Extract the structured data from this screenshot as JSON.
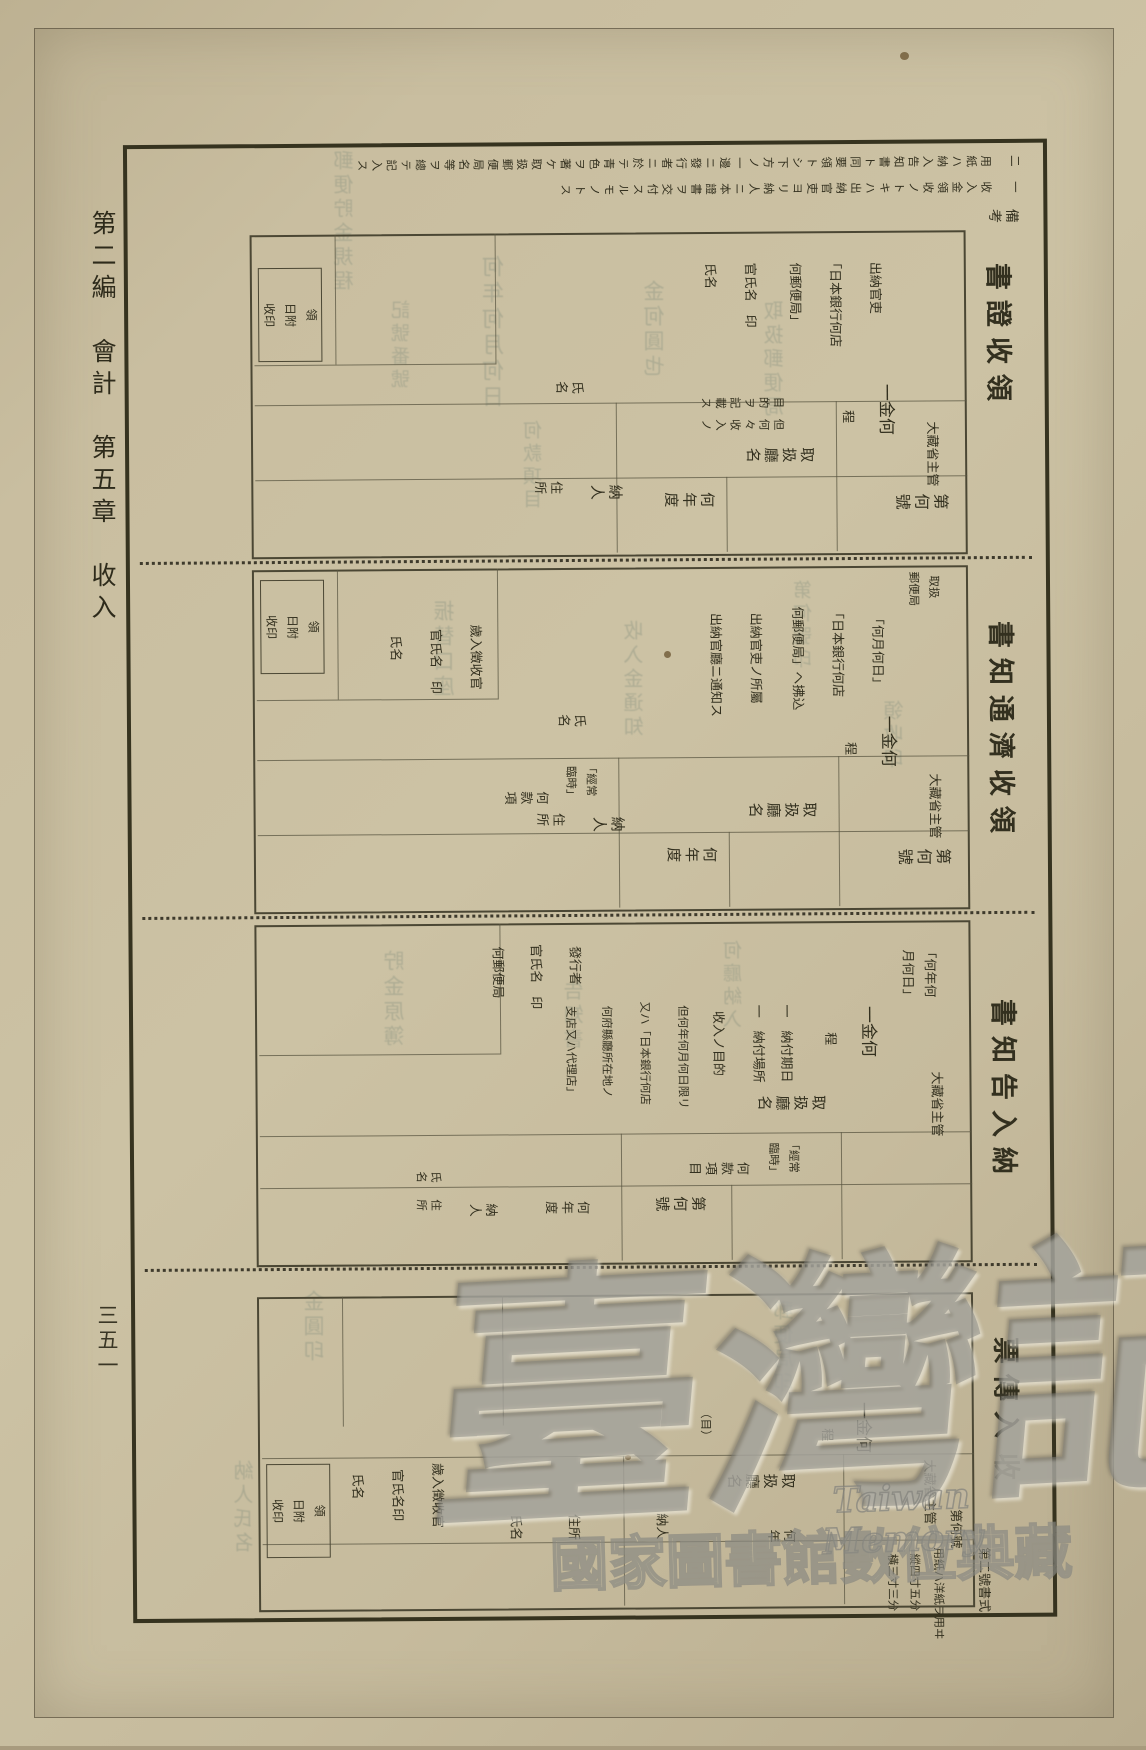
{
  "margin": {
    "chapter_header": "第二編　會計　第五章　收入",
    "page_number": "三五一"
  },
  "remarks_header": "備考",
  "sections": [
    {
      "title": "領收證書",
      "fields": {
        "serial": "第何號",
        "year": "何年度",
        "ministry": "大藏省主管",
        "office": "取扱廳名",
        "amount": "一金何",
        "amount_unit": "程",
        "purpose_1": "但何々收入ノ",
        "purpose_2": "目的ヲ記載ス",
        "payer": "納人",
        "address": "住所",
        "name": "氏名"
      },
      "instructions": [
        "出納官吏",
        "「日本銀行何店",
        "何郵便局」",
        "官氏名　印",
        "氏名"
      ],
      "stamp_box": [
        "領",
        "日附",
        "收印"
      ],
      "notes": [
        "一　收入金領收ノトキハ出納官吏ヨリ納人ニ本證書ヲ交付スルモノトス",
        "二　用紙ハ納入告知書ト同要領トシ下方ノ一邊ニ發行者ニ於テ青色ヲ著ケ取扱郵便局名等ヲ總テ記入ス"
      ]
    },
    {
      "title": "領收濟通知書",
      "fields": {
        "serial": "第何號",
        "year": "何年度",
        "budget_bracket_1": "「經常",
        "budget_bracket_2": "臨時」",
        "budget": "何款項",
        "ministry": "大藏省主管",
        "office": "取扱廳名",
        "amount": "一金何",
        "amount_unit": "程",
        "payer": "納人",
        "address": "住所",
        "name": "氏名",
        "post_office_1": "取扱",
        "post_office_2": "郵便局"
      },
      "instructions": [
        "「何月何日」",
        "「日本銀行何店",
        "何郵便局」ヘ拂込",
        "出納官吏ノ所屬",
        "出納官廳ニ通知ス"
      ],
      "collector": [
        "歲入徵收官",
        "官氏名　印",
        "氏名"
      ],
      "stamp_box": [
        "領",
        "日附",
        "收印"
      ]
    },
    {
      "title": "納入告知書",
      "fields": {
        "serial": "第何號",
        "year": "何年度",
        "budget_bracket_1": "「經常",
        "budget_bracket_2": "臨時」",
        "budget": "何款項目",
        "ministry": "大藏省主管",
        "office": "取扱廳名",
        "amount": "一金何",
        "amount_unit": "程",
        "date_1": "「何年何",
        "date_2": "月何日」",
        "due": "一　納付期日",
        "place": "一　納付場所",
        "payer": "納人",
        "address": "住所",
        "name": "氏名"
      },
      "instructions": [
        "收入ノ目的",
        "但何年何月何日限リ",
        "又ハ「日本銀行何店",
        "何府縣廳所在地ノ",
        "支店又ハ代理店」"
      ],
      "issuer": [
        "發行者",
        "官氏名　印",
        "何郵便局"
      ],
      "stamp_box": []
    },
    {
      "title": "收入傳票",
      "title_parts": [
        "入傳票",
        "收"
      ],
      "form_no": "第二號書式",
      "paper_note": [
        "用紙ハ洋紙ヲ用ヰ",
        "縱四寸五分",
        "橫三寸三分"
      ],
      "fields": {
        "serial": "第何號",
        "year": "何年",
        "ministry": "大藏省主管",
        "office": "取扱廳名",
        "amount": "一金何",
        "amount_unit": "程",
        "category": "（目）",
        "payer": "納人",
        "address": "住所",
        "name": "氏名"
      },
      "collector": [
        "歲入徵收官",
        "官氏名印",
        "氏名"
      ],
      "stamp_box": [
        "領",
        "日附",
        "收印"
      ]
    }
  ],
  "watermark": {
    "main": "臺灣記憶",
    "latin": "Taiwan Memory",
    "sub": "國家圖書館數位典藏"
  },
  "bleedthrough": [
    "郵便貯金規程",
    "何年何月何日",
    "記號番號",
    "金何圓也",
    "取扱郵便局",
    "振替口座",
    "收入金通知",
    "第何號印",
    "貯金原簿",
    "告知書",
    "何廳納入",
    "金圓印",
    "郵便局印",
    "納人氏名",
    "何款項目",
    "領收印"
  ]
}
